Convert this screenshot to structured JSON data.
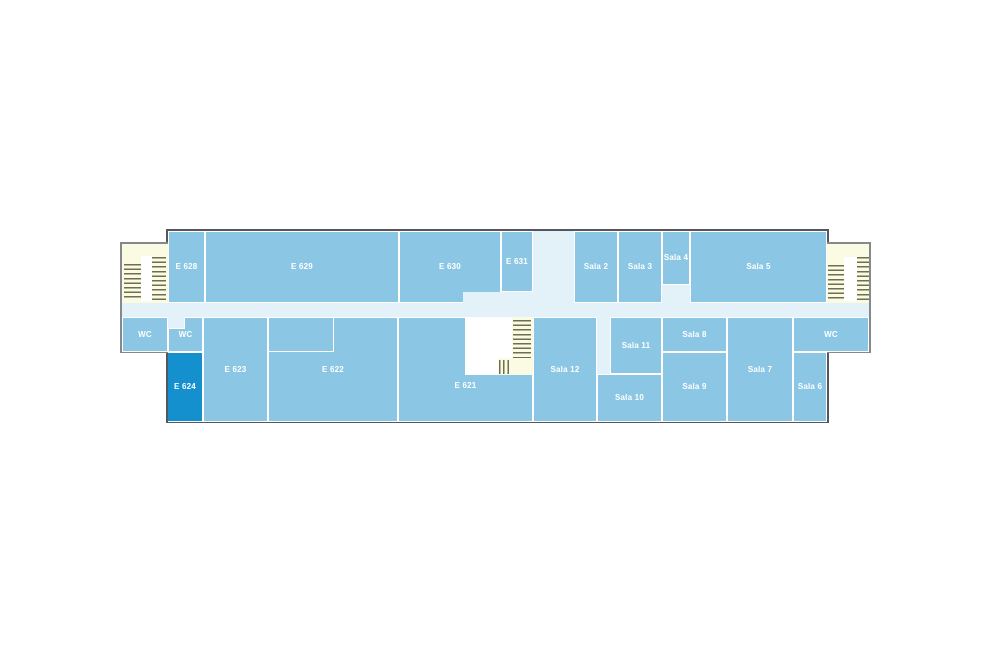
{
  "page": {
    "background": "#FFFFFF",
    "description_labels": []
  },
  "palette": {
    "room": "#8BC7E4",
    "room_highlight": "#1590CE",
    "corridor": "#E3F1F8",
    "stair_bg": "#FBFAE3",
    "stair_line": "#6E6E50",
    "divider": "#FFFFFF",
    "outline_main": "#54585C",
    "outline_annex": "#85898C",
    "label_text": "#FFFFFF"
  },
  "floorplan": {
    "highlighted_room": "E 624",
    "room_labels": [
      "E 628",
      "E 629",
      "E 630",
      "E 631",
      "Sala 2",
      "Sala 3",
      "Sala 4",
      "Sala 5",
      "WC",
      "WC",
      "E 624",
      "E 623",
      "E 622",
      "E 621",
      "Sala 12",
      "Sala 11",
      "Sala 10",
      "Sala 8",
      "Sala 9",
      "Sala 7",
      "WC",
      "Sala 6"
    ],
    "shapes": [
      {
        "name": "building-outline",
        "cls": "main",
        "x": 166,
        "y": 229,
        "w": 663,
        "h": 194,
        "interactable": false
      },
      {
        "name": "stairwell-annex-left",
        "cls": "annexL",
        "x": 120,
        "y": 242,
        "w": 48,
        "h": 111,
        "interactable": false
      },
      {
        "name": "stairwell-annex-right",
        "cls": "annexR",
        "x": 827,
        "y": 242,
        "w": 44,
        "h": 111,
        "interactable": false
      },
      {
        "name": "corridor-main",
        "cls": "corridor",
        "x": 122,
        "y": 303,
        "w": 747,
        "h": 14,
        "interactable": false
      },
      {
        "name": "stairs-left-flight-a",
        "cls": "linesH",
        "x": 124,
        "y": 264,
        "w": 17,
        "h": 37,
        "interactable": false
      },
      {
        "name": "stairs-left-landing",
        "cls": "stairWhite",
        "x": 141,
        "y": 256,
        "w": 11,
        "h": 45,
        "interactable": false
      },
      {
        "name": "stairs-left-flight-b",
        "cls": "linesH",
        "x": 152,
        "y": 257,
        "w": 14,
        "h": 44,
        "interactable": false
      },
      {
        "name": "stairs-right-flight-a",
        "cls": "linesH",
        "x": 828,
        "y": 265,
        "w": 16,
        "h": 36,
        "interactable": false
      },
      {
        "name": "stairs-right-landing",
        "cls": "stairWhite",
        "x": 844,
        "y": 257,
        "w": 13,
        "h": 44,
        "interactable": false
      },
      {
        "name": "stairs-right-flight-b",
        "cls": "linesH",
        "x": 857,
        "y": 257,
        "w": 12,
        "h": 44,
        "interactable": false
      },
      {
        "name": "room-e628",
        "cls": "room",
        "label": "E 628",
        "x": 168,
        "y": 231,
        "w": 37,
        "h": 72,
        "interactable": true
      },
      {
        "name": "room-e629",
        "cls": "room",
        "label": "E 629",
        "x": 205,
        "y": 231,
        "w": 194,
        "h": 72,
        "interactable": true
      },
      {
        "name": "room-e630",
        "cls": "room",
        "label": "E 630",
        "x": 399,
        "y": 231,
        "w": 102,
        "h": 72,
        "interactable": true
      },
      {
        "name": "room-e631",
        "cls": "room",
        "label": "E 631",
        "x": 501,
        "y": 231,
        "w": 32,
        "h": 61,
        "interactable": true
      },
      {
        "name": "corridor-vertical-top",
        "cls": "corridor",
        "x": 533,
        "y": 231,
        "w": 41,
        "h": 72,
        "interactable": false
      },
      {
        "name": "room-sala-2",
        "cls": "room",
        "label": "Sala 2",
        "x": 574,
        "y": 231,
        "w": 44,
        "h": 72,
        "interactable": true
      },
      {
        "name": "room-sala-3",
        "cls": "room",
        "label": "Sala 3",
        "x": 618,
        "y": 231,
        "w": 44,
        "h": 72,
        "interactable": true
      },
      {
        "name": "room-sala-4",
        "cls": "room",
        "label": "Sala 4",
        "x": 662,
        "y": 231,
        "w": 28,
        "h": 54,
        "interactable": true
      },
      {
        "name": "room-sala-5",
        "cls": "room",
        "label": "Sala 5",
        "x": 690,
        "y": 231,
        "w": 137,
        "h": 72,
        "interactable": true
      },
      {
        "name": "corridor-notch-e630",
        "cls": "corridor",
        "x": 463,
        "y": 292,
        "w": 70,
        "h": 11,
        "interactable": false
      },
      {
        "name": "corridor-notch-sala-4",
        "cls": "corridor",
        "x": 663,
        "y": 285,
        "w": 26,
        "h": 18,
        "interactable": false
      },
      {
        "name": "room-wc-left-annex",
        "cls": "room",
        "label": "WC",
        "x": 122,
        "y": 317,
        "w": 46,
        "h": 35,
        "interactable": true
      },
      {
        "name": "room-wc-left",
        "cls": "room",
        "label": "WC",
        "x": 168,
        "y": 317,
        "w": 35,
        "h": 35,
        "interactable": true
      },
      {
        "name": "corridor-stub-wc",
        "cls": "stub",
        "x": 168,
        "y": 317,
        "w": 17,
        "h": 12,
        "interactable": false
      },
      {
        "name": "room-e624-highlighted",
        "cls": "roomDark",
        "label": "E 624",
        "x": 168,
        "y": 352,
        "w": 35,
        "h": 70,
        "interactable": true
      },
      {
        "name": "room-e623",
        "cls": "room",
        "label": "E 623",
        "x": 203,
        "y": 317,
        "w": 65,
        "h": 105,
        "interactable": true
      },
      {
        "name": "room-e622",
        "cls": "room",
        "label": "E 622",
        "x": 268,
        "y": 317,
        "w": 130,
        "h": 105,
        "interactable": true
      },
      {
        "name": "room-e622-subroom",
        "cls": "subOutline",
        "x": 268,
        "y": 317,
        "w": 66,
        "h": 35,
        "interactable": false
      },
      {
        "name": "room-e621",
        "cls": "room",
        "label": "E 621",
        "x": 398,
        "y": 317,
        "w": 135,
        "h": 105,
        "labelTop": 64,
        "interactable": true
      },
      {
        "name": "stairwell-center",
        "cls": "stairWhite",
        "x": 465,
        "y": 317,
        "w": 68,
        "h": 58,
        "interactable": false
      },
      {
        "name": "stairwell-center-strip",
        "cls": "stairBg",
        "x": 512,
        "y": 317,
        "w": 21,
        "h": 58,
        "interactable": false
      },
      {
        "name": "stairwell-center-strip-bottom",
        "cls": "stairBg",
        "x": 498,
        "y": 358,
        "w": 14,
        "h": 17,
        "interactable": false
      },
      {
        "name": "stairs-center-flight-h",
        "cls": "linesH",
        "x": 513,
        "y": 320,
        "w": 18,
        "h": 38,
        "interactable": false
      },
      {
        "name": "stairs-center-flight-v",
        "cls": "linesV",
        "x": 499,
        "y": 360,
        "w": 12,
        "h": 14,
        "interactable": false
      },
      {
        "name": "room-sala-12",
        "cls": "room",
        "label": "Sala 12",
        "x": 533,
        "y": 317,
        "w": 64,
        "h": 105,
        "interactable": true
      },
      {
        "name": "corridor-strip-sala-11",
        "cls": "corridor",
        "x": 597,
        "y": 317,
        "w": 13,
        "h": 57,
        "interactable": false
      },
      {
        "name": "room-sala-11",
        "cls": "room",
        "label": "Sala 11",
        "x": 610,
        "y": 317,
        "w": 52,
        "h": 57,
        "interactable": true
      },
      {
        "name": "room-sala-10",
        "cls": "room",
        "label": "Sala 10",
        "x": 597,
        "y": 374,
        "w": 65,
        "h": 48,
        "interactable": true
      },
      {
        "name": "room-sala-8",
        "cls": "room",
        "label": "Sala 8",
        "x": 662,
        "y": 317,
        "w": 65,
        "h": 35,
        "interactable": true
      },
      {
        "name": "room-sala-9",
        "cls": "room",
        "label": "Sala 9",
        "x": 662,
        "y": 352,
        "w": 65,
        "h": 70,
        "interactable": true
      },
      {
        "name": "room-sala-7",
        "cls": "room",
        "label": "Sala 7",
        "x": 727,
        "y": 317,
        "w": 66,
        "h": 105,
        "interactable": true
      },
      {
        "name": "room-wc-right",
        "cls": "room",
        "label": "WC",
        "x": 793,
        "y": 317,
        "w": 76,
        "h": 35,
        "interactable": true
      },
      {
        "name": "room-sala-6",
        "cls": "room",
        "label": "Sala 6",
        "x": 793,
        "y": 352,
        "w": 34,
        "h": 70,
        "interactable": true
      }
    ]
  }
}
